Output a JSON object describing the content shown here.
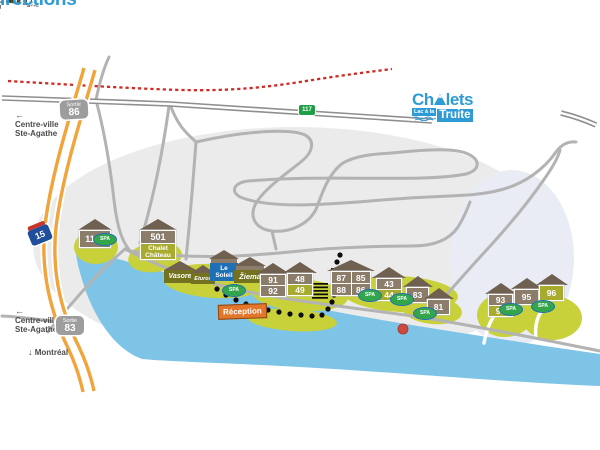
{
  "title": "Plan et directions",
  "logo": {
    "prefix": "Ch",
    "suffix": "lets",
    "sub_left": "Lac à la",
    "sub_right": "Truite"
  },
  "arrows": {
    "up": "↑",
    "down": "↓",
    "left": "←",
    "right": "→"
  },
  "directions": {
    "mont_tremblant": "Mont Tremblant",
    "val_david_top": "Val-David",
    "val_david_bottom": "Val-David",
    "centre_ville_line1": "Centre-ville",
    "centre_ville_line2": "Ste-Agathe",
    "montreal": "Montréal"
  },
  "streets": {
    "parc_lineaire": "Parc linéaire le P'tit Train du Nord",
    "rue_chamonix": "Rue Chamonix",
    "mont_rainer_1": "Mont Rainer",
    "mont_rainer_2": "Mont Rainer",
    "rue_diana": "Rue Diana",
    "rue_pauline": "Rue Pauline",
    "rue_edelweiss": "Rue Edelweiss",
    "avenue_gentenano": "Avenue Gentenano",
    "chemin_montagne_upper": "Chemin de la montagne",
    "chemin_montagne_lower": "Chemin de la montagne",
    "montee_alouette": "Montée Alouette",
    "rue_neufchatel": "Rue Neufchatel",
    "rue_nida": "Rue Nida"
  },
  "badges": {
    "sortie_label": "Sortie",
    "exit_86": "86",
    "exit_83": "83",
    "route_15": "15",
    "route_117": "117"
  },
  "chalets": {
    "c1130": "1130",
    "c501_number": "501",
    "c501_name_line1": "Chalet",
    "c501_name_line2": "Château",
    "vasore": "Vasore",
    "eturos": "Eturos",
    "le_soleil_line1": "Le",
    "le_soleil_line2": "Soleil",
    "ziema": "Žiema"
  },
  "units": {
    "n91": "91",
    "n92": "92",
    "n48": "48",
    "n49": "49",
    "n87": "87",
    "n85": "85",
    "n88": "88",
    "n86": "86",
    "n43": "43",
    "n44": "44",
    "n83": "83",
    "n81": "81",
    "n93": "93",
    "n94": "94",
    "n95": "95",
    "n96": "96"
  },
  "labels": {
    "reception": "Réception",
    "beach": "Plage-Beach",
    "lake": "Lac à la truite",
    "spa": "SPA"
  },
  "colors": {
    "accent_blue": "#2E9BD6",
    "lake_blue": "#7EC4E6",
    "olive_green": "#C8D139",
    "building_brown": "#8C7D6B",
    "roof_brown": "#6F6050",
    "highway_orange": "#F2A43C",
    "rail_red": "#CF2B24",
    "reception_orange": "#E2762B",
    "spa_green": "#33A64C",
    "road_gray": "#B3B3B3"
  }
}
